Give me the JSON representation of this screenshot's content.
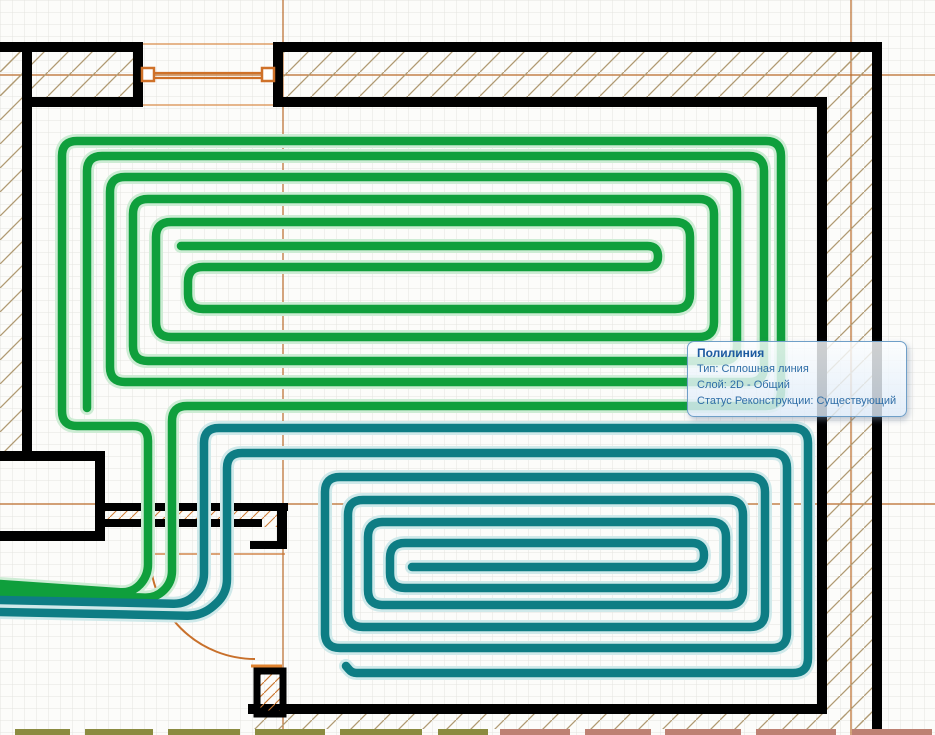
{
  "app": {
    "background": "#fcfcfa",
    "grid": {
      "spacing": 12,
      "color": "#e4e4e0"
    }
  },
  "tooltip": {
    "title": "Полилиния",
    "lines": [
      "Тип: Сплошная линия",
      "Слой: 2D - Общий",
      "Статус Реконструкции: Существующий"
    ],
    "title_color": "#1c5aa0",
    "text_color": "#2e6da6",
    "border_color": "#6f9fc8"
  },
  "colors": {
    "wall": "#000000",
    "hatch_tan": "#b09a72",
    "hatch_orange": "#cc7a33",
    "axis_orange": "#b96a28",
    "window_orange": "#cf7129",
    "window_light": "#d98c4a",
    "door_arc": "#c8702b",
    "pipe_green": "#0f9f3c",
    "pipe_green_halo": "#cdecd4",
    "pipe_teal": "#0e7d84",
    "pipe_teal_halo": "#cfe9ea",
    "mark_olive": "#8b8b40",
    "mark_brick": "#bd8173"
  },
  "drawing": {
    "axes": [
      {
        "x1": 0,
        "y1": 75,
        "x2": 935,
        "y2": 75
      },
      {
        "x1": 0,
        "y1": 504,
        "x2": 935,
        "y2": 504
      },
      {
        "x1": 283,
        "y1": 0,
        "x2": 283,
        "y2": 735
      },
      {
        "x1": 851,
        "y1": 0,
        "x2": 851,
        "y2": 735
      }
    ],
    "hatch_tan_regions": [
      {
        "x": 0,
        "y": 52,
        "w": 133,
        "h": 45
      },
      {
        "x": 283,
        "y": 52,
        "w": 589,
        "h": 45
      },
      {
        "x": 827,
        "y": 52,
        "w": 45,
        "h": 674
      },
      {
        "x": 252,
        "y": 714,
        "w": 620,
        "h": 15
      },
      {
        "x": 0,
        "y": 52,
        "w": 22,
        "h": 399
      }
    ],
    "hatch_orange_regions": [
      {
        "x": 102,
        "y": 505,
        "w": 183,
        "h": 22
      },
      {
        "x": 258,
        "y": 672,
        "w": 24,
        "h": 41
      }
    ],
    "walls": [
      {
        "x": 0,
        "y": 42,
        "w": 143,
        "h": 10
      },
      {
        "x": 133,
        "y": 42,
        "w": 10,
        "h": 65
      },
      {
        "x": 27,
        "y": 97,
        "w": 116,
        "h": 10
      },
      {
        "x": 22,
        "y": 47,
        "w": 10,
        "h": 406
      },
      {
        "x": 273,
        "y": 42,
        "w": 10,
        "h": 65
      },
      {
        "x": 273,
        "y": 42,
        "w": 609,
        "h": 10
      },
      {
        "x": 283,
        "y": 97,
        "w": 544,
        "h": 10
      },
      {
        "x": 872,
        "y": 42,
        "w": 10,
        "h": 693
      },
      {
        "x": 817,
        "y": 97,
        "w": 10,
        "h": 617
      },
      {
        "x": 248,
        "y": 704,
        "w": 579,
        "h": 10
      },
      {
        "x": 0,
        "y": 451,
        "w": 105,
        "h": 10
      },
      {
        "x": 95,
        "y": 451,
        "w": 10,
        "h": 90
      },
      {
        "x": 0,
        "y": 531,
        "w": 105,
        "h": 10
      },
      {
        "x": 100,
        "y": 503,
        "w": 188,
        "h": 8
      },
      {
        "x": 100,
        "y": 519,
        "w": 162,
        "h": 8
      },
      {
        "x": 277,
        "y": 503,
        "w": 10,
        "h": 46
      },
      {
        "x": 250,
        "y": 541,
        "w": 37,
        "h": 8
      }
    ],
    "wall_outlines": [
      {
        "x": 257,
        "y": 671,
        "w": 26,
        "h": 43,
        "sw": 7
      }
    ],
    "window": {
      "face_lines": [
        {
          "x1": 143,
          "y1": 44,
          "x2": 273,
          "y2": 44
        },
        {
          "x1": 143,
          "y1": 105,
          "x2": 273,
          "y2": 105
        }
      ],
      "mid_lines": [
        {
          "x1": 152,
          "y1": 73,
          "x2": 264,
          "y2": 73
        },
        {
          "x1": 152,
          "y1": 78,
          "x2": 264,
          "y2": 78
        }
      ],
      "squares": [
        {
          "x": 142,
          "y": 68,
          "w": 12,
          "h": 13
        },
        {
          "x": 262,
          "y": 68,
          "w": 12,
          "h": 13
        }
      ]
    },
    "door": {
      "threshold": {
        "x1": 148,
        "y1": 554,
        "x2": 285,
        "y2": 554
      },
      "arc": {
        "cx": 255,
        "cy": 554,
        "r": 105
      },
      "tick": {
        "x1": 251,
        "y1": 666,
        "x2": 282,
        "y2": 666
      }
    },
    "bottom_marks": {
      "y": 729,
      "h": 6,
      "olive": [
        [
          15,
          55
        ],
        [
          85,
          68
        ],
        [
          168,
          72
        ],
        [
          255,
          70
        ],
        [
          340,
          82
        ],
        [
          438,
          50
        ]
      ],
      "brick": [
        [
          500,
          70
        ],
        [
          585,
          66
        ],
        [
          665,
          76
        ],
        [
          756,
          80
        ],
        [
          852,
          80
        ]
      ]
    },
    "pipes": [
      {
        "id": "heating-circuit-1-outer",
        "color": "green",
        "points": [
          [
            0,
            584
          ],
          [
            132,
            593
          ],
          [
            148,
            576
          ],
          [
            148,
            426
          ],
          [
            62,
            426
          ],
          [
            62,
            141
          ],
          [
            781,
            141
          ],
          [
            781,
            406
          ],
          [
            172,
            406
          ],
          [
            172,
            582
          ],
          [
            156,
            598
          ],
          [
            0,
            592
          ]
        ]
      },
      {
        "id": "heating-circuit-1-inner",
        "color": "green",
        "points": [
          [
            87,
            408
          ],
          [
            87,
            156
          ],
          [
            764,
            156
          ],
          [
            764,
            382
          ],
          [
            110,
            382
          ],
          [
            110,
            177
          ],
          [
            737,
            177
          ],
          [
            737,
            361
          ],
          [
            133,
            361
          ],
          [
            133,
            199
          ],
          [
            714,
            199
          ],
          [
            714,
            337
          ],
          [
            156,
            337
          ],
          [
            156,
            222
          ],
          [
            690,
            222
          ],
          [
            690,
            309
          ],
          [
            188,
            309
          ],
          [
            188,
            267
          ],
          [
            658,
            267
          ],
          [
            658,
            246
          ],
          [
            181,
            246
          ]
        ]
      },
      {
        "id": "heating-circuit-2-outer",
        "color": "teal",
        "points": [
          [
            0,
            600
          ],
          [
            186,
            604
          ],
          [
            204,
            586
          ],
          [
            204,
            428
          ],
          [
            808,
            428
          ],
          [
            808,
            673
          ],
          [
            352,
            673
          ],
          [
            346,
            666
          ]
        ]
      },
      {
        "id": "heating-circuit-2-inner",
        "color": "teal",
        "points": [
          [
            0,
            612
          ],
          [
            202,
            616
          ],
          [
            227,
            594
          ],
          [
            227,
            453
          ],
          [
            787,
            453
          ],
          [
            787,
            648
          ],
          [
            325,
            648
          ],
          [
            325,
            477
          ],
          [
            765,
            477
          ],
          [
            765,
            627
          ],
          [
            348,
            627
          ],
          [
            348,
            500
          ],
          [
            743,
            500
          ],
          [
            743,
            605
          ],
          [
            368,
            605
          ],
          [
            368,
            522
          ],
          [
            726,
            522
          ],
          [
            726,
            588
          ],
          [
            390,
            588
          ],
          [
            390,
            543
          ],
          [
            704,
            543
          ],
          [
            704,
            567
          ],
          [
            412,
            567
          ]
        ]
      }
    ],
    "pipe_width": 8.5,
    "pipe_halo_width": 14,
    "corner_radius": 15
  }
}
